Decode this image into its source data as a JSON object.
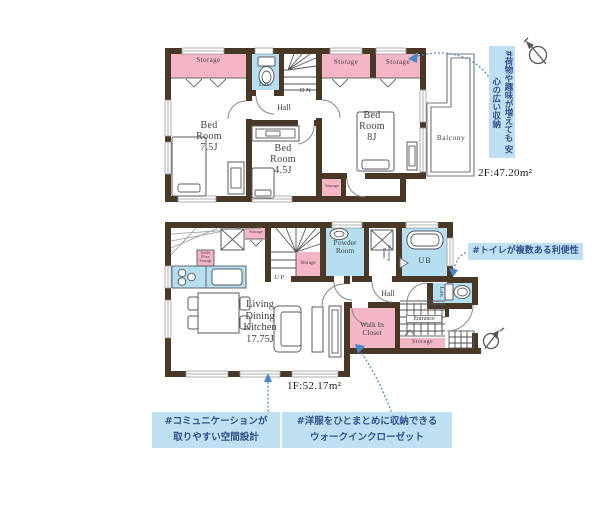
{
  "floor2": {
    "area_label": "2F:47.20m²",
    "labels": {
      "storage_left": "Storage",
      "storage_right_1": "Storage",
      "storage_right_2": "Storage",
      "storage_small": "Storage",
      "lav": "Lav.",
      "stairs_direction": "DN",
      "hall": "Hall",
      "balcony": "Balcony"
    },
    "rooms": {
      "bedroom_75": {
        "lines": [
          "Bed",
          "Room",
          "7.5J"
        ]
      },
      "bedroom_45": {
        "lines": [
          "Bed",
          "Room",
          "4.5J"
        ]
      },
      "bedroom_8": {
        "lines": [
          "Bed",
          "Room",
          "8J"
        ]
      }
    },
    "callout_storage": {
      "lines": [
        "#荷物や趣味が増えても",
        "安心の広い収納"
      ]
    }
  },
  "floor1": {
    "area_label": "1F:52.17m²",
    "labels": {
      "storage_top": "Storage",
      "storage_under_stairs": "Storage",
      "storage_entrance": "Storage",
      "stairs_direction": "UP",
      "bath": "UB",
      "lav": "Lav.",
      "hall": "Hall",
      "entrance": "Entrance",
      "powder": {
        "lines": [
          "Powder",
          "Room"
        ]
      },
      "dressing": {
        "lines": [
          "Dressing",
          "Room"
        ]
      },
      "walk_in_closet": {
        "lines": [
          "Walk In",
          "Closet"
        ]
      },
      "under_floor": {
        "lines": [
          "Under",
          "Floor",
          "Storage"
        ]
      },
      "ldk": {
        "lines": [
          "Living",
          "Dining",
          "Kitchen",
          "17.75J"
        ]
      }
    },
    "callout_toilet": "#トイレが複数ある利便性",
    "callout_communication": {
      "lines": [
        "#コミュニケーションが",
        "取りやすい空間設計"
      ]
    },
    "callout_wic": {
      "lines": [
        "#洋服をひとまとめに収納できる",
        "ウォークインクローゼット"
      ]
    }
  },
  "colors": {
    "wall": "#4a3826",
    "room_pink": "#f4b6c5",
    "water_blue": "#b5dff0",
    "callout_bg": "#bfe0f2",
    "callout_text": "#33508f",
    "leader_blue": "#4a86c8"
  }
}
